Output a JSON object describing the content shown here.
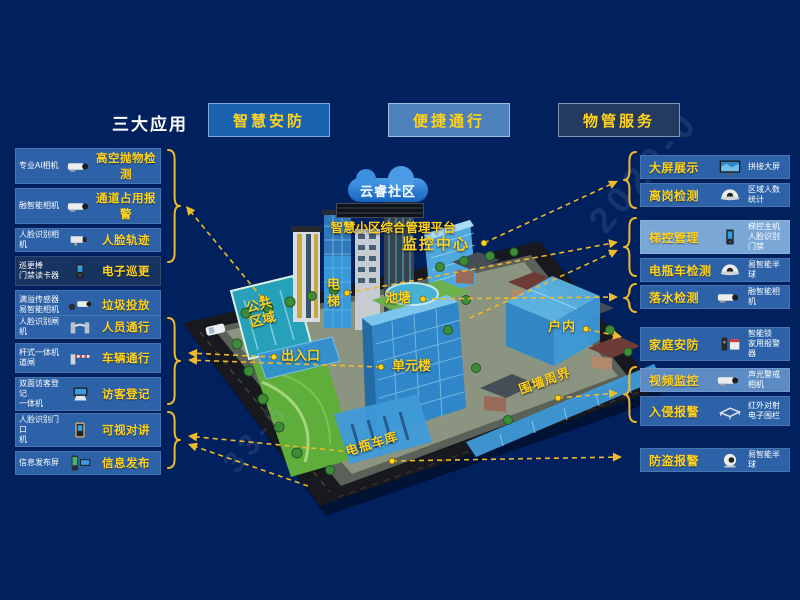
{
  "page": {
    "watermarks": [
      "2020-0",
      "33-6"
    ]
  },
  "colors": {
    "bg": "#00215e",
    "yellow": "#ffd21e",
    "arrow": "#f0b929",
    "row_mid": "#2d62a8",
    "row_light": "#7ba7d7",
    "row_soft": "#5d8cc4",
    "row_dark": "#17335f",
    "btn_blue": "#1a63b0",
    "btn_light": "#4e80ba",
    "btn_dark": "#243a5e"
  },
  "header": {
    "title": "三大应用",
    "tabs": [
      {
        "label": "智慧安防"
      },
      {
        "label": "便捷通行"
      },
      {
        "label": "物管服务"
      }
    ]
  },
  "left_panel": {
    "groups": [
      {
        "items": [
          {
            "device": "专业AI相机",
            "icon": "bullet-camera",
            "label": "高空抛物检测",
            "tone": "mid"
          },
          {
            "device": "融智能相机",
            "icon": "bullet-camera",
            "label": "通道占用报警",
            "tone": "mid"
          },
          {
            "device": "人脸识别相机",
            "icon": "box-camera",
            "label": "人脸轨迹",
            "tone": "mid"
          },
          {
            "device": "巡更棒\n门禁读卡器",
            "icon": "access-reader",
            "label": "电子巡更",
            "tone": "dark"
          },
          {
            "device": "满溢传感器\n易智能相机",
            "icon": "sensor-camera",
            "label": "垃圾投放",
            "tone": "mid"
          }
        ]
      },
      {
        "items": [
          {
            "device": "人脸识别闸机",
            "icon": "turnstile",
            "label": "人员通行",
            "tone": "mid"
          },
          {
            "device": "杆式一体机\n道闸",
            "icon": "barrier-gate",
            "label": "车辆通行",
            "tone": "mid"
          },
          {
            "device": "双面访客登记\n一体机",
            "icon": "visitor-terminal",
            "label": "访客登记",
            "tone": "mid"
          }
        ]
      },
      {
        "items": [
          {
            "device": "人脸识别门口\n机",
            "icon": "door-station",
            "label": "可视对讲",
            "tone": "mid"
          },
          {
            "device": "信息发布屏",
            "icon": "info-kiosk",
            "label": "信息发布",
            "tone": "mid"
          }
        ]
      }
    ]
  },
  "right_panel": {
    "groups": [
      {
        "items": [
          {
            "label": "大屏展示",
            "icon": "video-wall",
            "device": "拼接大屏",
            "tone": "mid"
          },
          {
            "label": "离岗检测",
            "icon": "dome-camera",
            "device": "区域人数统计",
            "tone": "mid"
          }
        ]
      },
      {
        "items": [
          {
            "label": "梯控管理",
            "icon": "elevator-terminal",
            "device": "梯控主机\n人脸识别门禁",
            "tone": "light"
          },
          {
            "label": "电瓶车检测",
            "icon": "dome-camera",
            "device": "易智能半球",
            "tone": "mid"
          }
        ]
      },
      {
        "items": [
          {
            "label": "落水检测",
            "icon": "bullet-camera",
            "device": "融智能相机",
            "tone": "mid"
          }
        ]
      },
      {
        "items": [
          {
            "label": "家庭安防",
            "icon": "lock-siren",
            "device": "智能锁\n家用报警器",
            "tone": "mid"
          }
        ]
      },
      {
        "items": [
          {
            "label": "视频监控",
            "icon": "bullet-camera",
            "device": "声光警戒相机",
            "tone": "soft"
          },
          {
            "label": "入侵报警",
            "icon": "perimeter-fence",
            "device": "红外对射\n电子围栏",
            "tone": "mid"
          }
        ]
      },
      {
        "items": [
          {
            "label": "防盗报警",
            "icon": "turret-camera",
            "device": "易智能半球",
            "tone": "mid"
          }
        ]
      }
    ]
  },
  "platform": {
    "cloud": "云睿社区",
    "name": "智慧小区综合管理平台"
  },
  "map": {
    "labels": {
      "monitor_center": "监控中心",
      "elevator": "电梯",
      "pond": "池塘",
      "public_area": "公共\n区域",
      "entrance": "出入口",
      "unit_building": "单元楼",
      "indoor": "户内",
      "perimeter": "围墙周界",
      "ebike_garage": "电瓶车库"
    }
  }
}
